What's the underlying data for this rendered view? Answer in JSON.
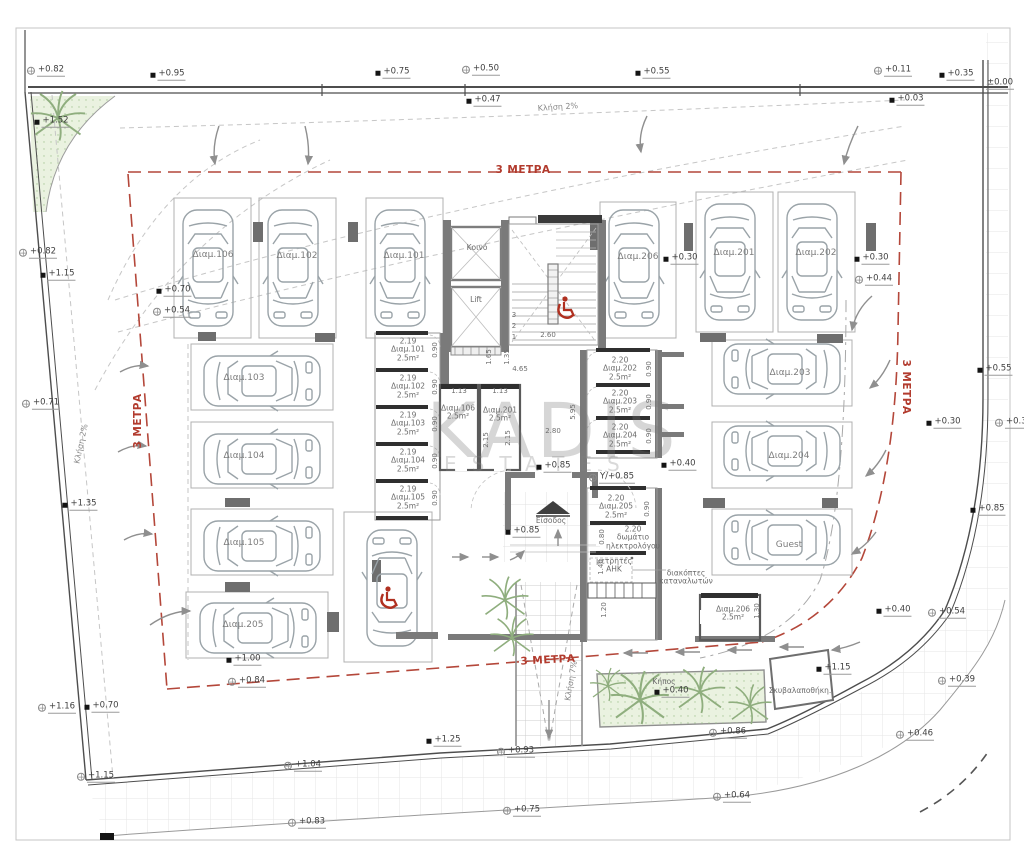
{
  "watermark": {
    "line1": "KADIS",
    "line2": "ESTATES"
  },
  "annotations": {
    "parking": [
      {
        "t": "Διαμ.106",
        "x": 213,
        "y": 255
      },
      {
        "t": "Διαμ.102",
        "x": 297,
        "y": 256
      },
      {
        "t": "Διαμ.101",
        "x": 404,
        "y": 256
      },
      {
        "t": "Διαμ.206",
        "x": 638,
        "y": 257
      },
      {
        "t": "Διαμ.201",
        "x": 734,
        "y": 253
      },
      {
        "t": "Διαμ.202",
        "x": 816,
        "y": 253
      },
      {
        "t": "Διαμ.103",
        "x": 244,
        "y": 378
      },
      {
        "t": "Διαμ.104",
        "x": 244,
        "y": 456
      },
      {
        "t": "Διαμ.105",
        "x": 244,
        "y": 543
      },
      {
        "t": "Διαμ.205",
        "x": 243,
        "y": 625
      },
      {
        "t": "Διαμ.203",
        "x": 790,
        "y": 373
      },
      {
        "t": "Διαμ.204",
        "x": 789,
        "y": 456
      },
      {
        "t": "Guest",
        "x": 789,
        "y": 545
      }
    ],
    "rooms": [
      {
        "t": "Κοινό",
        "x": 477,
        "y": 248
      },
      {
        "t": "Lift",
        "x": 476,
        "y": 300
      },
      {
        "t": "2.19\nΔιαμ.101\n2.5m²",
        "x": 408,
        "y": 350
      },
      {
        "t": "2.19\nΔιαμ.102\n2.5m²",
        "x": 408,
        "y": 387
      },
      {
        "t": "2.19\nΔιαμ.103\n2.5m²",
        "x": 408,
        "y": 424
      },
      {
        "t": "2.19\nΔιαμ.104\n2.5m²",
        "x": 408,
        "y": 461
      },
      {
        "t": "2.19\nΔιαμ.105\n2.5m²",
        "x": 408,
        "y": 498
      },
      {
        "t": "Διαμ.106\n2.5m²",
        "x": 458,
        "y": 413
      },
      {
        "t": "Διαμ.201\n2.5m²",
        "x": 500,
        "y": 415
      },
      {
        "t": "2.20\nΔιαμ.202\n2.5m²",
        "x": 620,
        "y": 369
      },
      {
        "t": "2.20\nΔιαμ.203\n2.5m²",
        "x": 620,
        "y": 402
      },
      {
        "t": "2.20\nΔιαμ.204\n2.5m²",
        "x": 620,
        "y": 436
      },
      {
        "t": "2.20\nΔιαμ.205\n2.5m²",
        "x": 616,
        "y": 507
      },
      {
        "t": "2.20\nδωμάτιο\nηλεκτρολόγου",
        "x": 633,
        "y": 538
      },
      {
        "t": "μετρητές\nΑΗΚ",
        "x": 614,
        "y": 566
      },
      {
        "t": "διακόπτες\nκαταναλωτών",
        "x": 686,
        "y": 578
      },
      {
        "t": "Διαμ.206\n2.5m²",
        "x": 733,
        "y": 614
      },
      {
        "t": "Είσοδος",
        "x": 551,
        "y": 521
      },
      {
        "t": "Κήπος",
        "x": 664,
        "y": 682
      },
      {
        "t": "Σκυβαλαποθήκη.",
        "x": 800,
        "y": 691
      }
    ],
    "dims": [
      {
        "t": "2.60",
        "x": 548,
        "y": 336
      },
      {
        "t": "1.65",
        "x": 490,
        "y": 357,
        "rot": -90
      },
      {
        "t": "1.35",
        "x": 508,
        "y": 357,
        "rot": -90
      },
      {
        "t": "4.65",
        "x": 520,
        "y": 370
      },
      {
        "t": "5.95",
        "x": 574,
        "y": 412,
        "rot": -90
      },
      {
        "t": "2.80",
        "x": 553,
        "y": 432
      },
      {
        "t": "1.13",
        "x": 459,
        "y": 392
      },
      {
        "t": "1.13",
        "x": 500,
        "y": 392
      },
      {
        "t": "2.15",
        "x": 487,
        "y": 440,
        "rot": -90
      },
      {
        "t": "2.15",
        "x": 509,
        "y": 438,
        "rot": -90
      },
      {
        "t": "0.90",
        "x": 436,
        "y": 350,
        "rot": -90
      },
      {
        "t": "0.90",
        "x": 436,
        "y": 387,
        "rot": -90
      },
      {
        "t": "0.90",
        "x": 436,
        "y": 424,
        "rot": -90
      },
      {
        "t": "0.90",
        "x": 436,
        "y": 461,
        "rot": -90
      },
      {
        "t": "0.90",
        "x": 436,
        "y": 498,
        "rot": -90
      },
      {
        "t": "0.90",
        "x": 650,
        "y": 369,
        "rot": -90
      },
      {
        "t": "0.90",
        "x": 650,
        "y": 402,
        "rot": -90
      },
      {
        "t": "0.90",
        "x": 650,
        "y": 436,
        "rot": -90
      },
      {
        "t": "0.90",
        "x": 648,
        "y": 509,
        "rot": -90
      },
      {
        "t": "0.80",
        "x": 603,
        "y": 537,
        "rot": -90
      },
      {
        "t": "1.40",
        "x": 602,
        "y": 567,
        "rot": -90
      },
      {
        "t": "1.20",
        "x": 605,
        "y": 610,
        "rot": -90
      },
      {
        "t": "1.30",
        "x": 758,
        "y": 611,
        "rot": -90
      },
      {
        "t": "3",
        "x": 514,
        "y": 316
      },
      {
        "t": "2",
        "x": 514,
        "y": 327
      },
      {
        "t": "1",
        "x": 514,
        "y": 338
      }
    ],
    "elevations": [
      {
        "t": "+0.82",
        "x": 46,
        "y": 71,
        "m": 0
      },
      {
        "t": "+0.95",
        "x": 168,
        "y": 75,
        "m": 1
      },
      {
        "t": "+0.75",
        "x": 393,
        "y": 73,
        "m": 1
      },
      {
        "t": "+0.50",
        "x": 481,
        "y": 70,
        "m": 0
      },
      {
        "t": "+0.47",
        "x": 484,
        "y": 101,
        "m": 1
      },
      {
        "t": "+0.55",
        "x": 653,
        "y": 73,
        "m": 1
      },
      {
        "t": "+0.11",
        "x": 893,
        "y": 71,
        "m": 0
      },
      {
        "t": "+0.35",
        "x": 957,
        "y": 75,
        "m": 1
      },
      {
        "t": "±0.00",
        "x": 1000,
        "y": 84,
        "m": 2
      },
      {
        "t": "+0.03",
        "x": 907,
        "y": 100,
        "m": 1
      },
      {
        "t": "+1.52",
        "x": 52,
        "y": 122,
        "m": 1
      },
      {
        "t": "+0.82",
        "x": 38,
        "y": 253,
        "m": 0
      },
      {
        "t": "+1.15",
        "x": 58,
        "y": 275,
        "m": 1
      },
      {
        "t": "+0.70",
        "x": 174,
        "y": 291,
        "m": 1
      },
      {
        "t": "+0.54",
        "x": 172,
        "y": 312,
        "m": 0
      },
      {
        "t": "+0.71",
        "x": 41,
        "y": 404,
        "m": 0
      },
      {
        "t": "+1.35",
        "x": 80,
        "y": 505,
        "m": 1
      },
      {
        "t": "+1.16",
        "x": 57,
        "y": 708,
        "m": 0
      },
      {
        "t": "+0.70",
        "x": 102,
        "y": 707,
        "m": 1
      },
      {
        "t": "+1.15",
        "x": 96,
        "y": 777,
        "m": 0
      },
      {
        "t": "+1.00",
        "x": 244,
        "y": 660,
        "m": 1
      },
      {
        "t": "+0.84",
        "x": 247,
        "y": 682,
        "m": 0
      },
      {
        "t": "+1.04",
        "x": 303,
        "y": 766,
        "m": 0
      },
      {
        "t": "+0.83",
        "x": 307,
        "y": 823,
        "m": 0
      },
      {
        "t": "+1.25",
        "x": 444,
        "y": 741,
        "m": 1
      },
      {
        "t": "+0.93",
        "x": 516,
        "y": 752,
        "m": 0
      },
      {
        "t": "+0.75",
        "x": 522,
        "y": 811,
        "m": 0
      },
      {
        "t": "+0.86",
        "x": 728,
        "y": 733,
        "m": 0
      },
      {
        "t": "+0.64",
        "x": 732,
        "y": 797,
        "m": 0
      },
      {
        "t": "+0.46",
        "x": 915,
        "y": 735,
        "m": 0
      },
      {
        "t": "+0.39",
        "x": 957,
        "y": 681,
        "m": 0
      },
      {
        "t": "+0.55",
        "x": 995,
        "y": 370,
        "m": 1
      },
      {
        "t": "+0.30",
        "x": 944,
        "y": 423,
        "m": 1
      },
      {
        "t": "+0.34",
        "x": 1014,
        "y": 423,
        "m": 0
      },
      {
        "t": "+0.85",
        "x": 988,
        "y": 510,
        "m": 1
      },
      {
        "t": "+0.40",
        "x": 894,
        "y": 611,
        "m": 1
      },
      {
        "t": "+0.54",
        "x": 947,
        "y": 613,
        "m": 0
      },
      {
        "t": "+1.15",
        "x": 834,
        "y": 669,
        "m": 1
      },
      {
        "t": "+0.30",
        "x": 681,
        "y": 259,
        "m": 1
      },
      {
        "t": "+0.30",
        "x": 872,
        "y": 259,
        "m": 1
      },
      {
        "t": "+0.44",
        "x": 874,
        "y": 280,
        "m": 0
      },
      {
        "t": "+0.85",
        "x": 554,
        "y": 467,
        "m": 1
      },
      {
        "t": "Υ/+0.85",
        "x": 612,
        "y": 478,
        "m": 0
      },
      {
        "t": "+0.85",
        "x": 523,
        "y": 532,
        "m": 1
      },
      {
        "t": "+0.40",
        "x": 679,
        "y": 465,
        "m": 1
      },
      {
        "t": "+0.40",
        "x": 672,
        "y": 692,
        "m": 1
      }
    ],
    "red_setback": [
      {
        "t": "3 ΜΕΤΡΑ",
        "x": 523,
        "y": 171
      },
      {
        "t": "3 ΜΕΤΡΑ",
        "x": 139,
        "y": 421,
        "rot": -90
      },
      {
        "t": "3 ΜΕΤΡΑ",
        "x": 905,
        "y": 387,
        "rot": 90
      },
      {
        "t": "3 ΜΕΤΡΑ",
        "x": 548,
        "y": 661,
        "rot": -3
      }
    ],
    "slopes": [
      {
        "t": "Κλήση 2%",
        "x": 558,
        "y": 108,
        "rot": -4
      },
      {
        "t": "Κλήση 2%",
        "x": 82,
        "y": 444,
        "rot": -78
      },
      {
        "t": "Κλήση 7%",
        "x": 572,
        "y": 681,
        "rot": -80
      }
    ]
  }
}
